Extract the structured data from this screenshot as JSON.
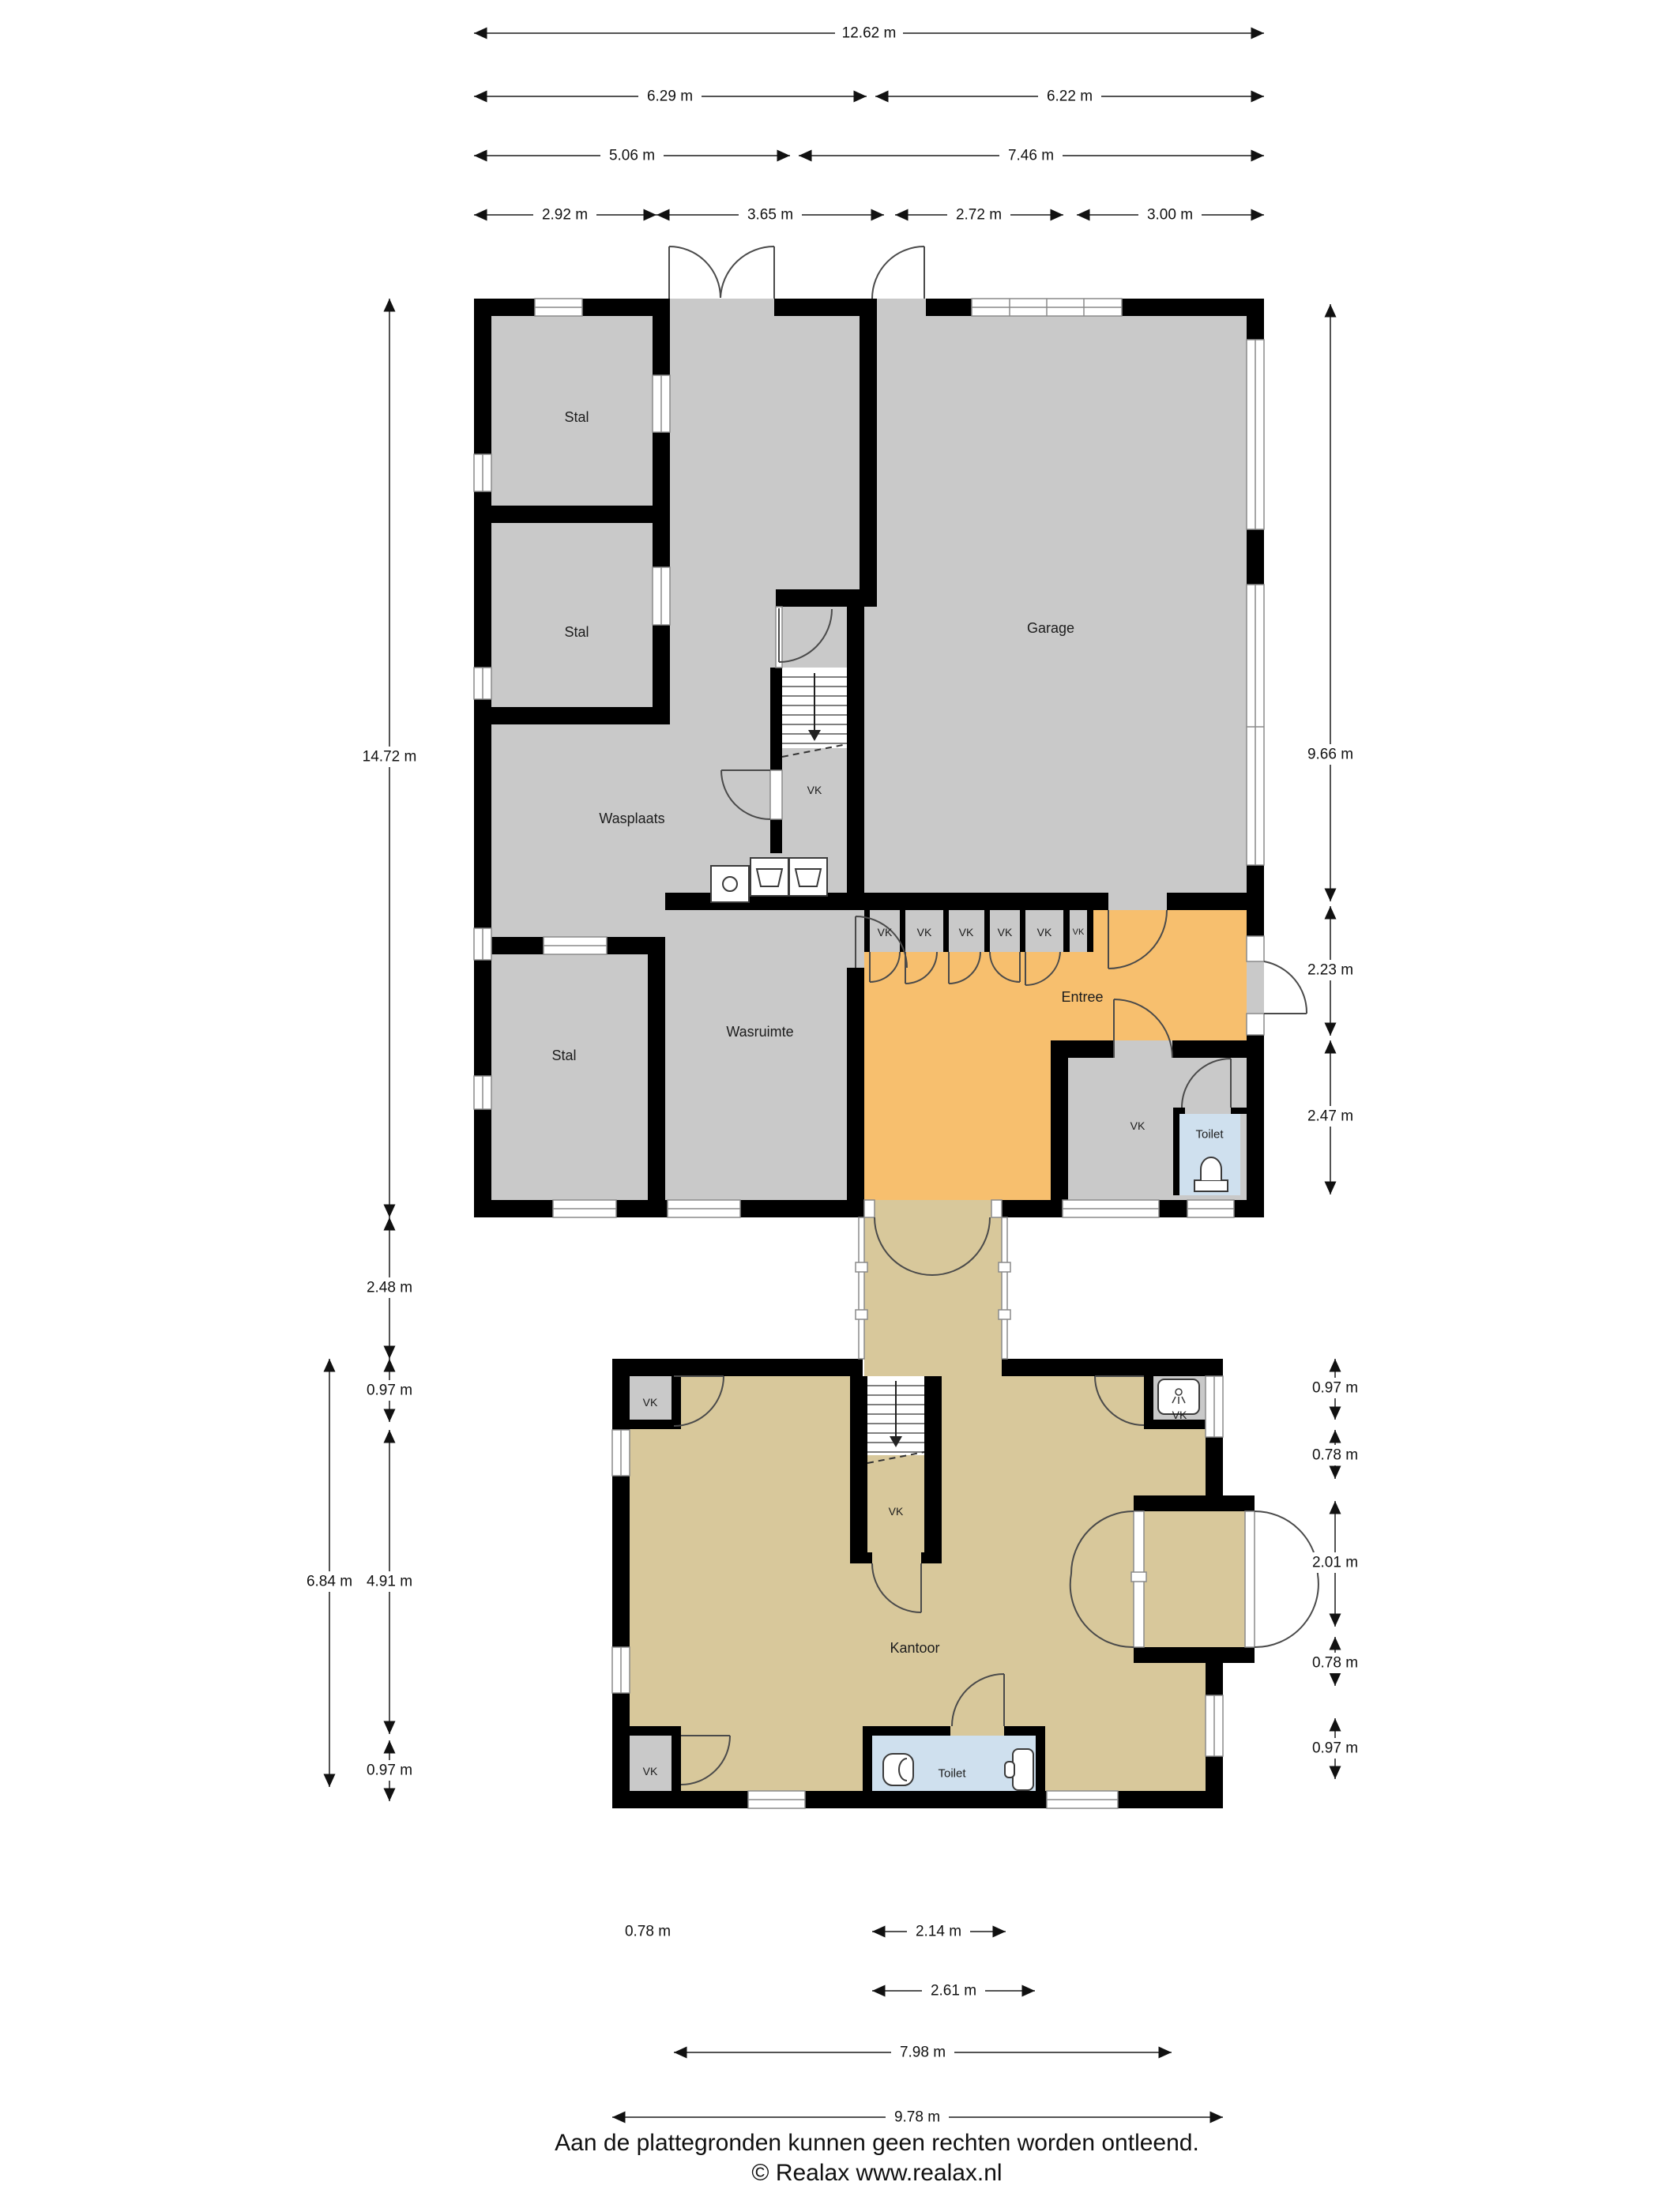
{
  "document": {
    "kind": "floorplan",
    "footer": {
      "disclaimer": "Aan de plattegronden kunnen geen rechten worden ontleend.",
      "copyright": "© Realax www.realax.nl"
    }
  },
  "rooms": {
    "stal": "Stal",
    "garage": "Garage",
    "wasplaats": "Wasplaats",
    "wasruimte": "Wasruimte",
    "entree": "Entree",
    "vk": "VK",
    "toilet": "Toilet",
    "kantoor": "Kantoor"
  },
  "dimensions": {
    "top": [
      "12.62 m",
      "6.29 m",
      "6.22 m",
      "5.06 m",
      "7.46 m",
      "2.92 m",
      "3.65 m",
      "2.72 m",
      "3.00 m"
    ],
    "left": [
      "14.72 m",
      "2.48 m",
      "0.97 m",
      "6.84 m",
      "4.91 m",
      "0.97 m"
    ],
    "right_upper": [
      "9.66 m",
      "2.23 m",
      "2.47 m"
    ],
    "right_lower": [
      "0.97 m",
      "0.78 m",
      "2.01 m",
      "0.78 m",
      "0.97 m"
    ],
    "bottom": [
      "0.78 m",
      "2.14 m",
      "2.61 m",
      "7.98 m",
      "9.78 m"
    ]
  },
  "colors": {
    "room_grey": "#c9c9c9",
    "room_tan": "#d8c89b",
    "room_orange": "#f7bf6e",
    "room_blue": "#cfe0ee",
    "wall": "#000000"
  }
}
